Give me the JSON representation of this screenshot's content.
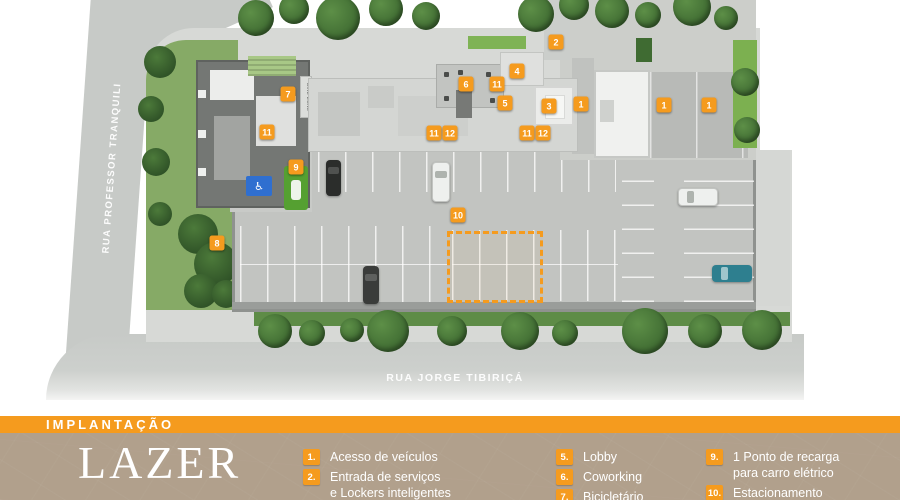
{
  "colors": {
    "accent": "#F59B1E",
    "panel_bg": "#B1A08C",
    "ev_spot_green": "#55A031",
    "handicap_blue": "#2F6FD0"
  },
  "banner": {
    "title": "IMPLANTAÇÃO"
  },
  "panel": {
    "title": "LAZER"
  },
  "map": {
    "street_left": "RUA PROFESSOR TRANQUILI",
    "street_bottom": "RUA JORGE TIBIRIÇÁ",
    "bike_zone": "BIKE ZONE",
    "markers": [
      {
        "label": "2",
        "x": 556,
        "y": 42
      },
      {
        "label": "4",
        "x": 517,
        "y": 71
      },
      {
        "label": "6",
        "x": 466,
        "y": 84
      },
      {
        "label": "11",
        "x": 497,
        "y": 84
      },
      {
        "label": "7",
        "x": 288,
        "y": 94
      },
      {
        "label": "5",
        "x": 505,
        "y": 103
      },
      {
        "label": "1",
        "x": 581,
        "y": 104
      },
      {
        "label": "3",
        "x": 549,
        "y": 106
      },
      {
        "label": "1",
        "x": 664,
        "y": 105
      },
      {
        "label": "1",
        "x": 709,
        "y": 105
      },
      {
        "label": "11",
        "x": 267,
        "y": 132
      },
      {
        "label": "11",
        "x": 434,
        "y": 133
      },
      {
        "label": "12",
        "x": 450,
        "y": 133
      },
      {
        "label": "11",
        "x": 527,
        "y": 133
      },
      {
        "label": "12",
        "x": 543,
        "y": 133
      },
      {
        "label": "9",
        "x": 296,
        "y": 167
      },
      {
        "label": "10",
        "x": 458,
        "y": 215
      },
      {
        "label": "8",
        "x": 217,
        "y": 243
      }
    ]
  },
  "legend": {
    "columns": [
      {
        "items": [
          {
            "num": "1.",
            "lines": [
              "Acesso de veículos"
            ]
          },
          {
            "num": "2.",
            "lines": [
              "Entrada de serviços",
              "e Lockers inteligentes"
            ]
          }
        ]
      },
      {
        "items": [
          {
            "num": "5.",
            "lines": [
              "Lobby"
            ]
          },
          {
            "num": "6.",
            "lines": [
              "Coworking"
            ]
          },
          {
            "num": "7.",
            "lines": [
              "Bicicletário"
            ]
          }
        ]
      },
      {
        "items": [
          {
            "num": "9.",
            "lines": [
              "1 Ponto de recarga",
              "para carro elétrico"
            ]
          },
          {
            "num": "10.",
            "lines": [
              "Estacionamento"
            ]
          }
        ]
      }
    ]
  }
}
